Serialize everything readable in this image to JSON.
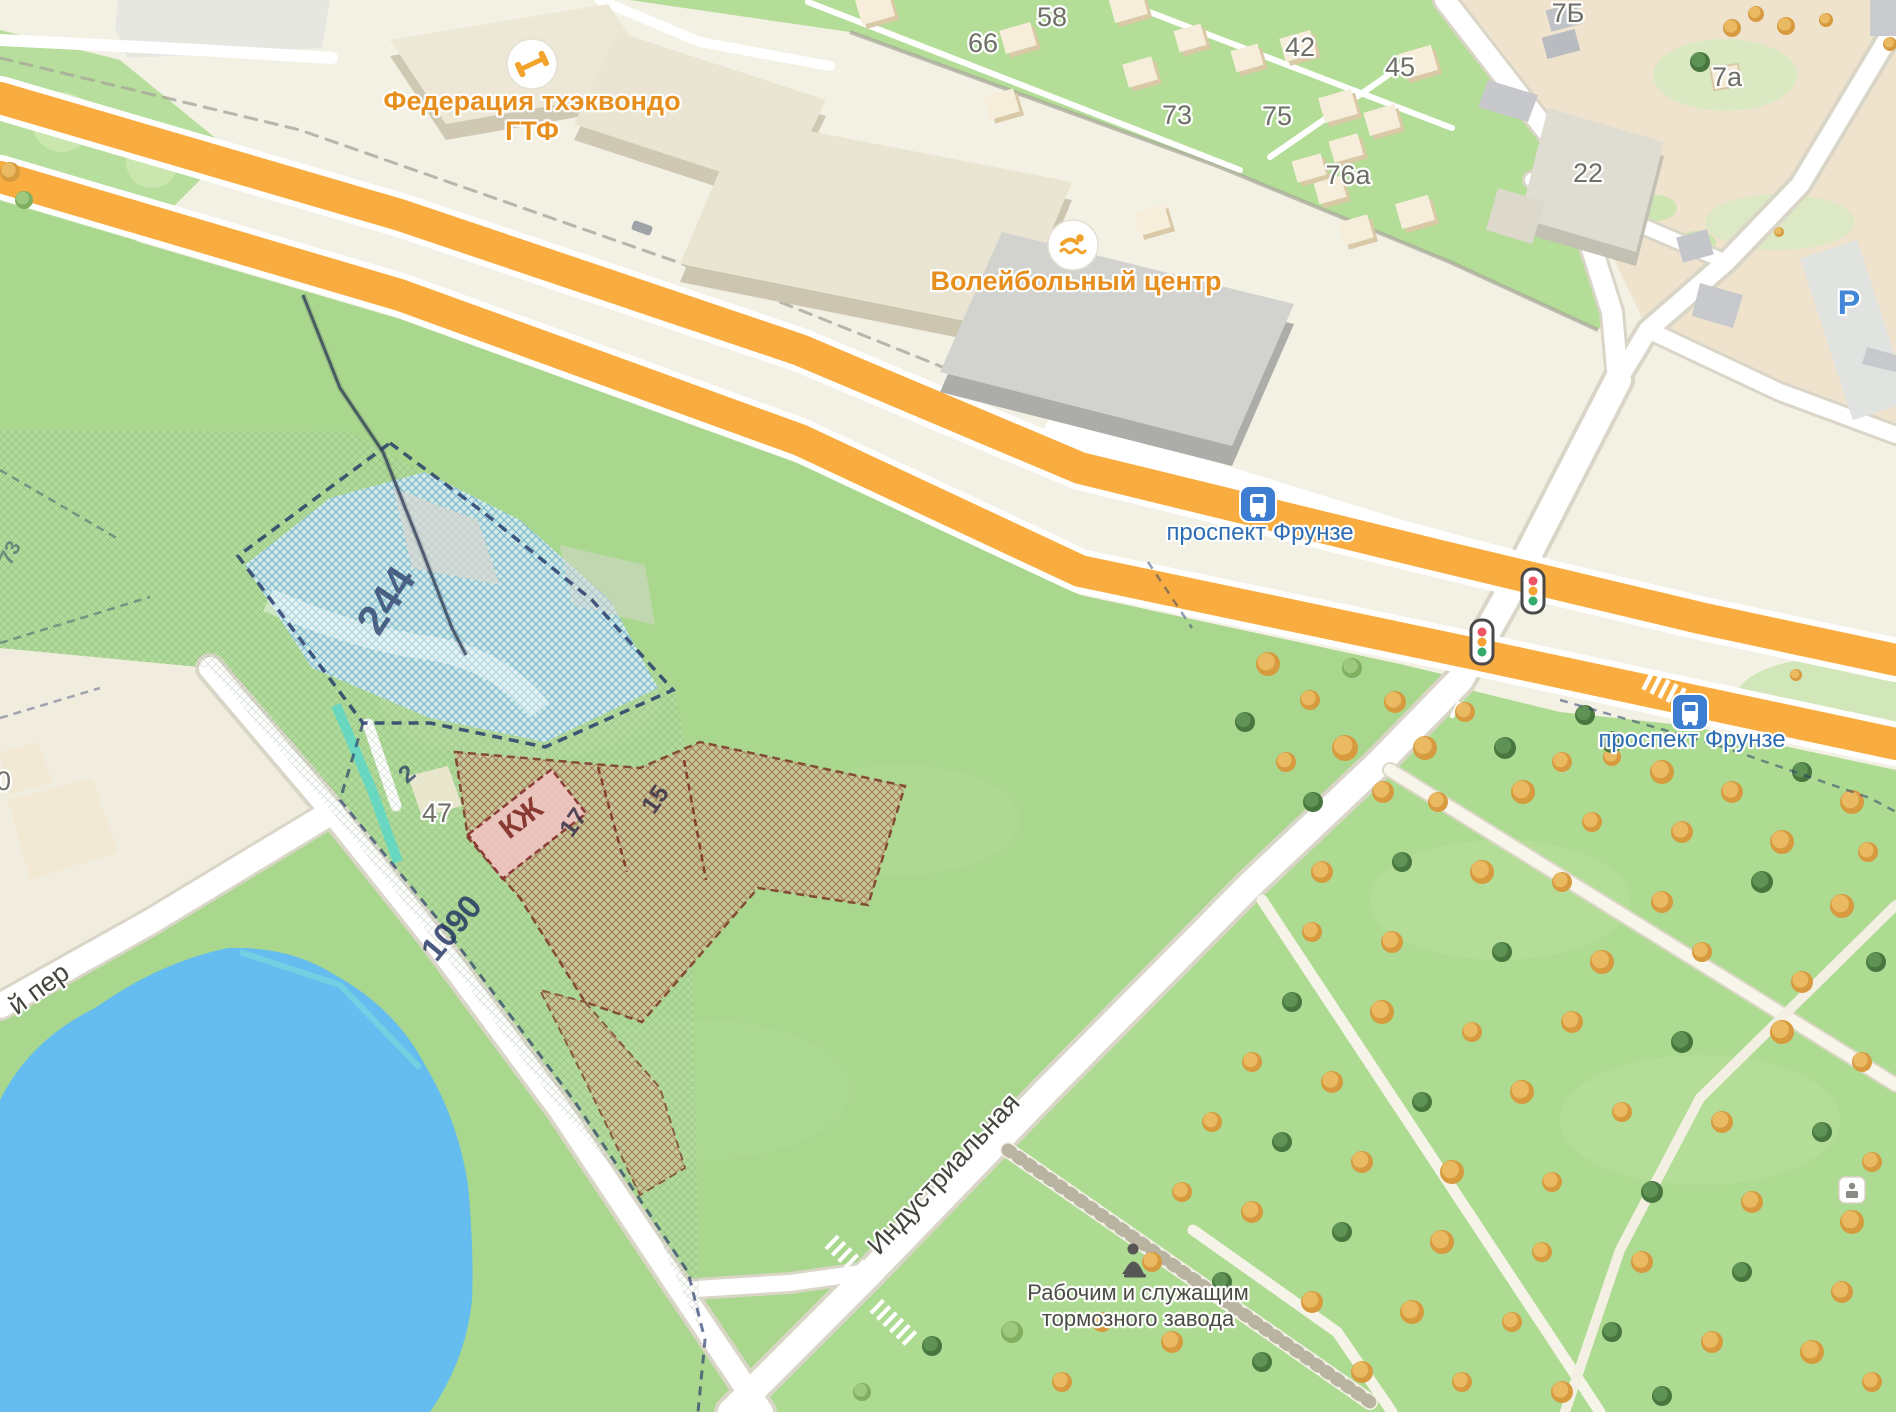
{
  "pois": {
    "taekwondo": {
      "line1": "Федерация тхэквондо",
      "line2": "ГТФ",
      "icon": "dumbbell"
    },
    "volleyball": {
      "label": "Волейбольный центр",
      "icon": "swimmer"
    }
  },
  "transit": {
    "stop1": "проспект Фрунзе",
    "stop2": "проспект Фрунзе"
  },
  "streets": {
    "industrial": "Индустриальная",
    "lane": "й пер"
  },
  "monument": {
    "line1": "Рабочим и служащим",
    "line2": "тормозного завода"
  },
  "parking": {
    "label": "Р"
  },
  "building_numbers": {
    "n58": "58",
    "n66": "66",
    "n73": "73",
    "n42": "42",
    "n45": "45",
    "n75": "75",
    "n76a": "76а",
    "n7b": "7Б",
    "n7a": "7а",
    "n22": "22",
    "n40": "40",
    "n47": "47"
  },
  "cadastral": {
    "p244": "244",
    "p1090": "1090",
    "pkzh": "КЖ",
    "p17": "17",
    "p15": "15",
    "p2": "2",
    "p73": "73"
  },
  "colors": {
    "highway_orange": "#F9AC3F",
    "water_blue": "#64BDEE",
    "lawn_green": "#A9D78E",
    "park_green": "#AEDB92",
    "cottage_green": "#B4DD97",
    "poi_orange": "#E78F1E",
    "transit_blue": "#2E6DB4",
    "cadastral_navy": "#24356B",
    "cadastral_red": "#8A2F26"
  }
}
